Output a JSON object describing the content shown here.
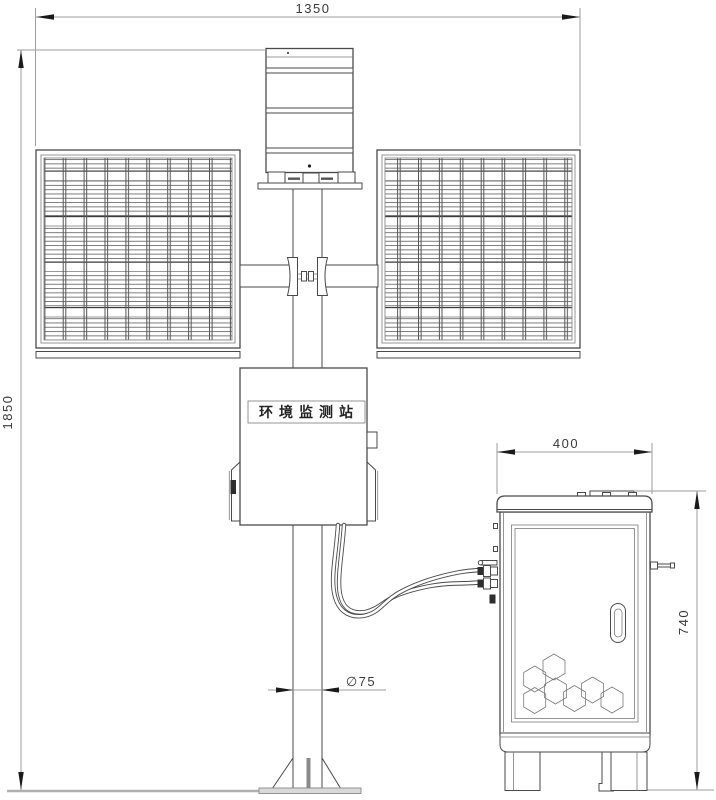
{
  "drawing": {
    "dimensions": {
      "overall_width": "1350",
      "overall_height": "1850",
      "enclosure_width": "400",
      "enclosure_height": "740",
      "pole_diameter": "∅75"
    },
    "labels": {
      "station_box": "环境监测站"
    },
    "colors": {
      "line": "#4a4a4a",
      "dimension_line": "#9e9e9e",
      "text": "#3a3a3a"
    }
  }
}
